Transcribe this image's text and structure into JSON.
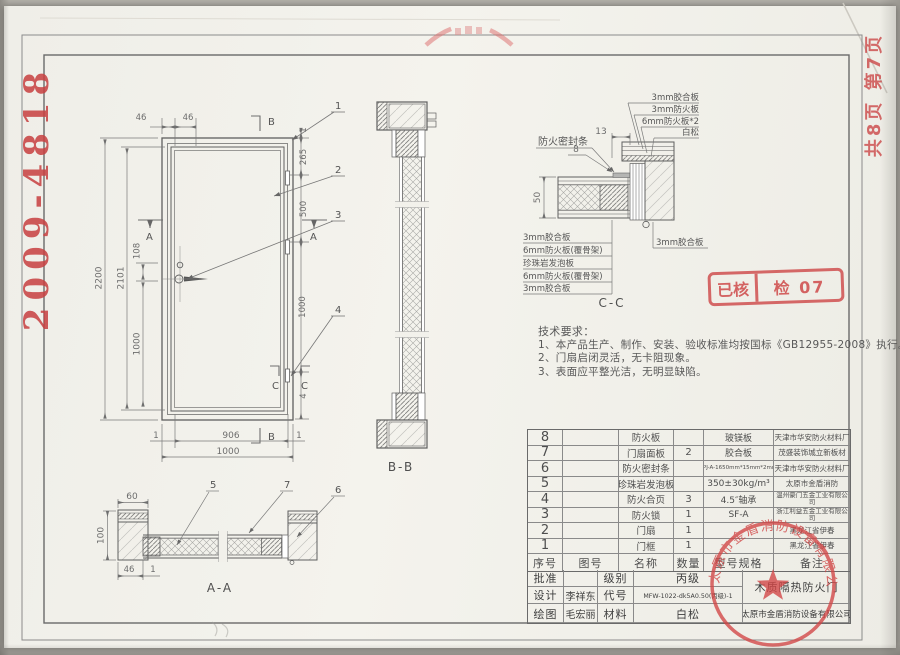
{
  "page": {
    "doc_number": "2009-4818",
    "page_info": "共8页 第7页"
  },
  "stamps": {
    "review_left": "已核",
    "review_right": "检 07",
    "circular_company": "太原市金盾消防设备有限公司"
  },
  "tech_notes": {
    "title": "技术要求：",
    "line1": "1、本产品生产、制作、安装、验收标准均按国标《GB12955-2008》执行。",
    "line2": "2、门扇启闭灵活，无卡阻现象。",
    "line3": "3、表面应平整光洁，无明显缺陷。"
  },
  "sections": {
    "aa": "A-A",
    "bb": "B-B",
    "cc": "C-C"
  },
  "elevation": {
    "d2200": "2200",
    "d2101": "2101",
    "d108": "108",
    "d1000l": "1000",
    "d46a": "46",
    "d46b": "46",
    "d1t": "1",
    "d265": "265",
    "d500": "500",
    "d1000r": "1000",
    "d4": "4",
    "d1bl": "1",
    "d906": "906",
    "d1br": "1",
    "d1000b": "1000",
    "mA": "A",
    "mB": "B",
    "mC": "C",
    "l1": "1",
    "l2": "2",
    "l3": "3",
    "l4": "4"
  },
  "aa": {
    "d60": "60",
    "d100": "100",
    "d46": "46",
    "d1": "1",
    "l5": "5",
    "l6": "6",
    "l7": "7"
  },
  "cc": {
    "t1": "3mm胶合板",
    "t2": "3mm防火板",
    "t3": "6mm防火板*2",
    "t4": "白松",
    "seal": "防火密封条",
    "d13": "13",
    "d8": "8",
    "d50": "50",
    "left": [
      "3mm胶合板",
      "6mm防火板(覆骨架)",
      "珍珠岩发泡板",
      "6mm防火板(覆骨架)",
      "3mm胶合板"
    ],
    "right": "3mm胶合板"
  },
  "parts_table": {
    "headers": [
      "序号",
      "图号",
      "名称",
      "数量",
      "型号规格",
      "备注"
    ],
    "rows": [
      {
        "no": "8",
        "fig": "",
        "name": "防火板",
        "qty": "",
        "spec": "玻镁板",
        "remark": "天津市华安防火材料厂"
      },
      {
        "no": "7",
        "fig": "",
        "name": "门扇面板",
        "qty": "2",
        "spec": "胶合板",
        "remark": "茂盛装饰城立新板材"
      },
      {
        "no": "6",
        "fig": "",
        "name": "防火密封条",
        "qty": "",
        "spec": "FPJ-A-1650mm*15mm*2mm",
        "remark": "天津市华安防火材料厂"
      },
      {
        "no": "5",
        "fig": "",
        "name": "珍珠岩发泡板",
        "qty": "",
        "spec": "350±30kg/m³",
        "remark": "太原市金盾消防"
      },
      {
        "no": "4",
        "fig": "",
        "name": "防火合页",
        "qty": "3",
        "spec": "4.5″轴承",
        "remark": "温州豪门五金工业有限公司"
      },
      {
        "no": "3",
        "fig": "",
        "name": "防火锁",
        "qty": "1",
        "spec": "SF-A",
        "remark": "浙江利益五金工业有限公司"
      },
      {
        "no": "2",
        "fig": "",
        "name": "门扇",
        "qty": "1",
        "spec": "",
        "remark": "黑龙江省伊春"
      },
      {
        "no": "1",
        "fig": "",
        "name": "门框",
        "qty": "1",
        "spec": "",
        "remark": "黑龙江省伊春"
      }
    ]
  },
  "title_block": {
    "approve_label": "批准",
    "grade_label": "级别",
    "grade": "丙级",
    "design_label": "设计",
    "designer": "李祥东",
    "code_label": "代号",
    "code": "MFW-1022-dk5A0.50(丙级)-1",
    "draw_label": "绘图",
    "drafter": "毛宏丽",
    "material_label": "材料",
    "material": "白松",
    "product_name": "木质隔热防火门",
    "company": "太原市金盾消防设备有限公司"
  }
}
